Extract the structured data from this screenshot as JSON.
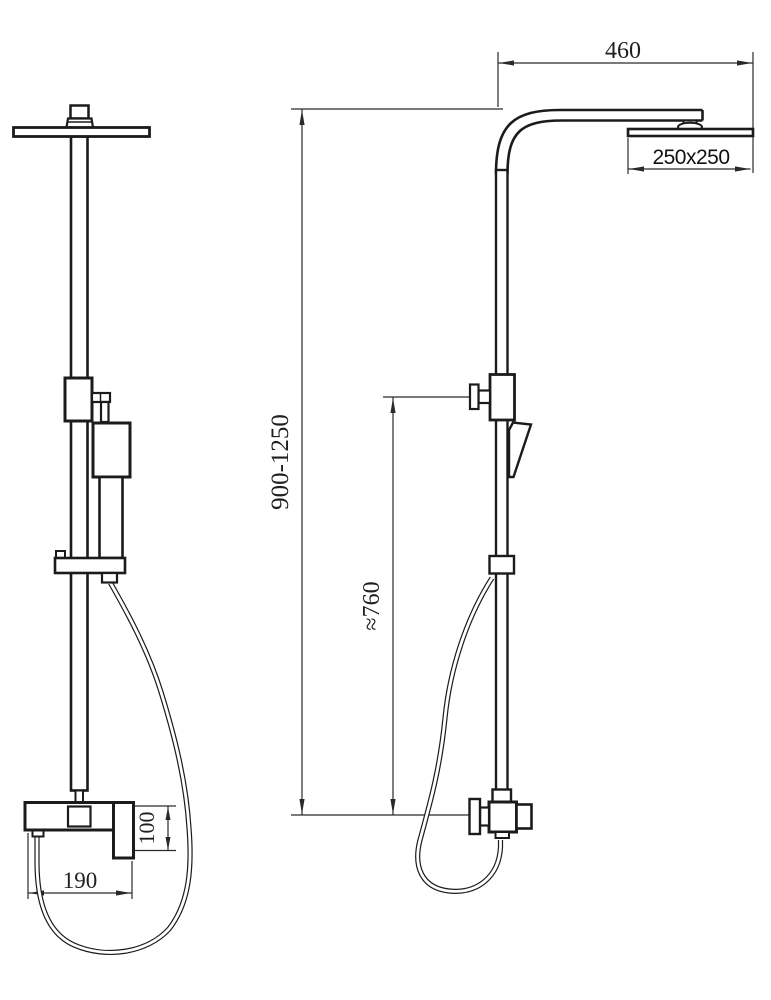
{
  "drawing": {
    "title": "shower-column-technical-drawing",
    "colors": {
      "line": "#1b1b1b",
      "dimension_line": "#2a2a2a",
      "background": "#ffffff"
    },
    "dimensions": {
      "arm_reach": "460",
      "head_size": "250x250",
      "column_height": "900-1250",
      "hand_shower_height": "≈760",
      "mixer_width": "190",
      "mixer_height": "100"
    }
  }
}
